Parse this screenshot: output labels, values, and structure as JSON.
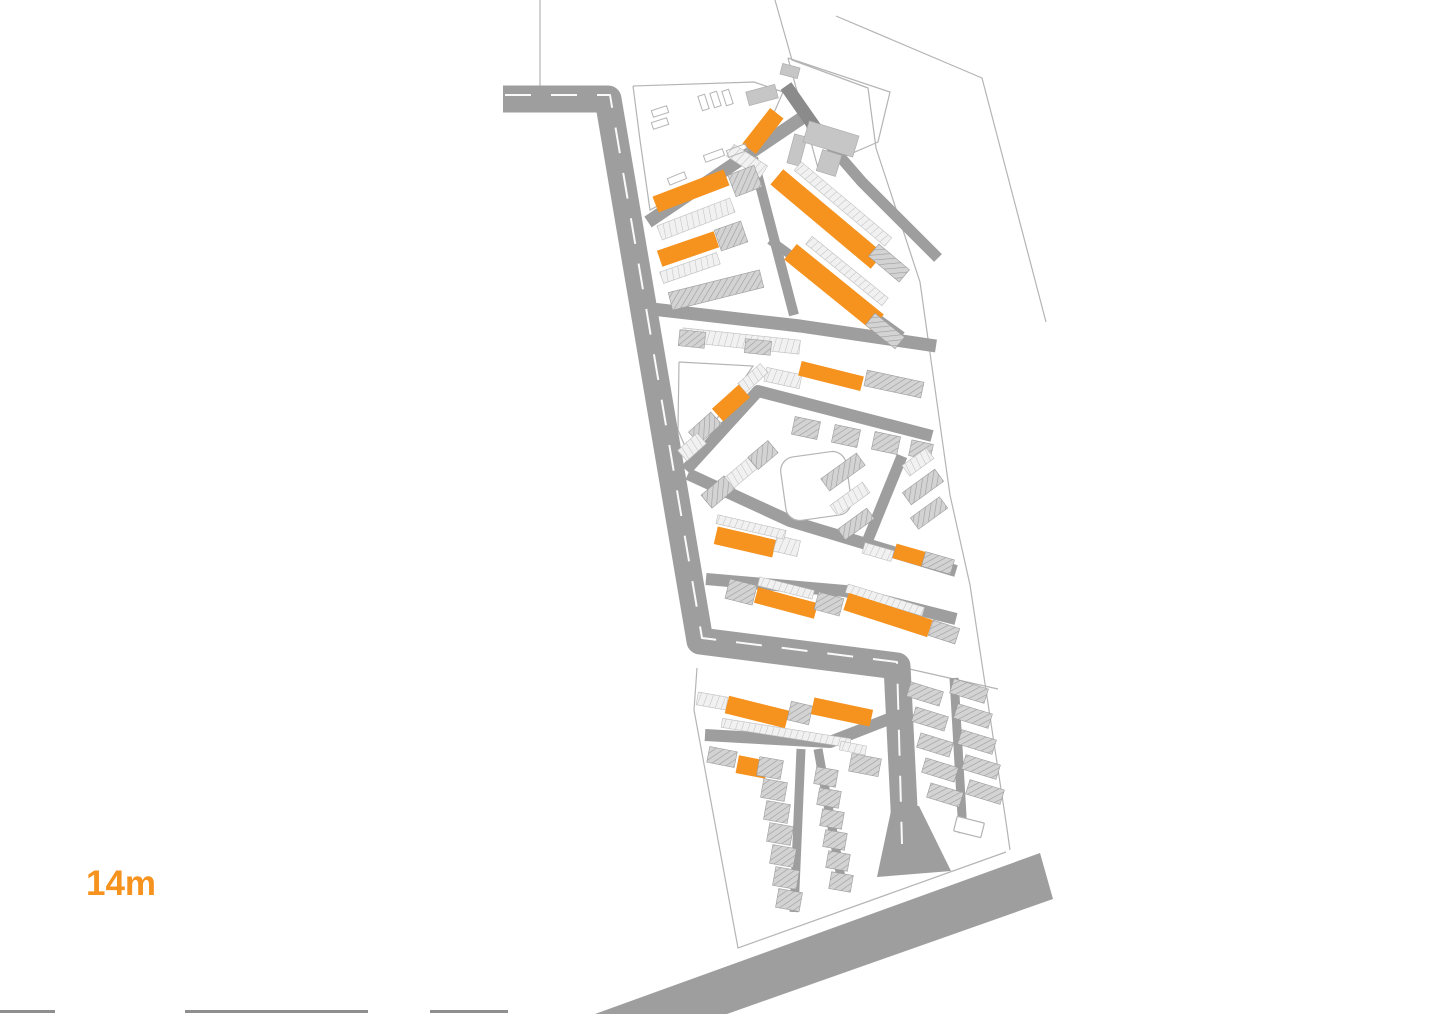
{
  "page": {
    "title": "site-plan",
    "label": {
      "text": "14m",
      "color": "#F6921E"
    }
  },
  "palette": {
    "background": "#ffffff",
    "orange": "#F6921E",
    "road": "#9E9E9E",
    "road_dark": "#8B8B8B",
    "centerline": "#FFFFFF",
    "hatch_fill": "#D3D3D3",
    "hatch_line": "#9C9C9C",
    "strip_fill": "#F1F1F1",
    "strip_line": "#BFBFBF",
    "solid_gray": "#C6C6C6",
    "outline": "#B4B4B4",
    "edge_mark": "#8F8F8F"
  },
  "legend": {
    "O": "highlighted-orange-building",
    "H": "hatched-gray-building",
    "S": "terraced-housing-strip",
    "G": "solid-gray-building"
  },
  "map": {
    "viewbox": [
      0,
      0,
      1436,
      1014
    ],
    "roads": [
      {
        "pts": [
          [
            503,
            99
          ],
          [
            608,
            99
          ],
          [
            700,
            641
          ],
          [
            897,
            666
          ],
          [
            906,
            848
          ]
        ],
        "w": 27,
        "dark": false
      },
      {
        "pts": [
          [
            648,
            222
          ],
          [
            802,
            118
          ]
        ],
        "w": 13,
        "dark": false
      },
      {
        "pts": [
          [
            786,
            86
          ],
          [
            816,
            129
          ]
        ],
        "w": 13,
        "dark": true
      },
      {
        "pts": [
          [
            816,
            129
          ],
          [
            862,
            182
          ],
          [
            938,
            258
          ]
        ],
        "w": 11,
        "dark": false
      },
      {
        "pts": [
          [
            770,
            240
          ],
          [
            902,
            336
          ]
        ],
        "w": 9,
        "dark": false
      },
      {
        "pts": [
          [
            753,
            158
          ],
          [
            789,
            296
          ],
          [
            794,
            315
          ]
        ],
        "w": 10,
        "dark": false
      },
      {
        "pts": [
          [
            652,
            309
          ],
          [
            800,
            326
          ],
          [
            936,
            346
          ]
        ],
        "w": 13,
        "dark": false
      },
      {
        "pts": [
          [
            686,
            470
          ],
          [
            758,
            391
          ],
          [
            932,
            436
          ]
        ],
        "w": 12,
        "dark": false
      },
      {
        "pts": [
          [
            688,
            474
          ],
          [
            790,
            521
          ],
          [
            956,
            571
          ]
        ],
        "w": 12,
        "dark": false
      },
      {
        "pts": [
          [
            902,
            456
          ],
          [
            867,
            542
          ]
        ],
        "w": 11,
        "dark": false
      },
      {
        "pts": [
          [
            706,
            579
          ],
          [
            845,
            591
          ],
          [
            956,
            619
          ]
        ],
        "w": 12,
        "dark": false
      },
      {
        "pts": [
          [
            705,
            735
          ],
          [
            830,
            742
          ],
          [
            889,
            719
          ]
        ],
        "w": 12,
        "dark": false
      },
      {
        "pts": [
          [
            801,
            749
          ],
          [
            794,
            912
          ]
        ],
        "w": 9,
        "dark": false
      },
      {
        "pts": [
          [
            818,
            749
          ],
          [
            843,
            889
          ]
        ],
        "w": 9,
        "dark": false
      },
      {
        "pts": [
          [
            954,
            678
          ],
          [
            963,
            833
          ]
        ],
        "w": 9,
        "dark": false
      }
    ],
    "road_polygons": [
      {
        "pts": [
          [
            595,
            1014
          ],
          [
            1040,
            853
          ],
          [
            1053,
            899
          ],
          [
            727,
            1014
          ]
        ]
      },
      {
        "pts": [
          [
            892,
            806
          ],
          [
            919,
            806
          ],
          [
            951,
            871
          ],
          [
            877,
            877
          ]
        ]
      }
    ],
    "centerlines": [
      {
        "pts": [
          [
            505,
            95
          ],
          [
            610,
            95
          ],
          [
            702,
            638
          ],
          [
            897,
            662
          ],
          [
            902,
            844
          ]
        ],
        "dash": "26 20",
        "w": 2
      }
    ],
    "outlines": [
      {
        "pts": [
          [
            775,
            0
          ],
          [
            792,
            60
          ],
          [
            868,
            88
          ],
          [
            876,
            148
          ],
          [
            920,
            282
          ],
          [
            950,
            495
          ],
          [
            970,
            585
          ],
          [
            1006,
            822
          ],
          [
            1010,
            850
          ]
        ]
      },
      {
        "pts": [
          [
            836,
            16
          ],
          [
            982,
            78
          ],
          [
            1046,
            322
          ]
        ]
      },
      {
        "pts": [
          [
            540,
            0
          ],
          [
            540,
            86
          ]
        ]
      },
      {
        "pts": [
          [
            697,
            668
          ],
          [
            694,
            710
          ],
          [
            738,
            948
          ],
          [
            1006,
            852
          ]
        ]
      },
      {
        "pts": [
          [
            633,
            86
          ],
          [
            754,
            82
          ],
          [
            783,
            92
          ],
          [
            757,
            152
          ],
          [
            650,
            210
          ],
          [
            640,
            140
          ],
          [
            633,
            86
          ]
        ]
      },
      {
        "pts": [
          [
            788,
            58
          ],
          [
            890,
            92
          ],
          [
            878,
            142
          ],
          [
            818,
            168
          ],
          [
            788,
            58
          ]
        ]
      },
      {
        "pts": [
          [
            679,
            362
          ],
          [
            753,
            366
          ],
          [
            690,
            458
          ],
          [
            678,
            430
          ],
          [
            679,
            362
          ]
        ]
      },
      {
        "pts": [
          [
            905,
            668
          ],
          [
            998,
            689
          ]
        ]
      }
    ],
    "buildings": [
      [
        "O",
        763,
        131,
        17,
        45,
        38
      ],
      [
        "G",
        762,
        95,
        30,
        14,
        -15
      ],
      [
        "G",
        790,
        71,
        18,
        11,
        15
      ],
      [
        "G",
        797,
        150,
        13,
        30,
        15
      ],
      [
        "G",
        831,
        139,
        52,
        22,
        17
      ],
      [
        "G",
        829,
        163,
        20,
        22,
        17
      ],
      [
        "S",
        747,
        161,
        40,
        14,
        33
      ],
      [
        "S",
        696,
        219,
        78,
        15,
        -21
      ],
      [
        "O",
        691,
        191,
        76,
        17,
        -21
      ],
      [
        "H",
        745,
        181,
        28,
        23,
        -21
      ],
      [
        "O",
        688,
        249,
        60,
        17,
        -19
      ],
      [
        "S",
        690,
        268,
        60,
        12,
        -19
      ],
      [
        "H",
        731,
        236,
        28,
        22,
        -19
      ],
      [
        "H",
        716,
        290,
        94,
        18,
        -14
      ],
      [
        "S",
        843,
        204,
        118,
        11,
        40
      ],
      [
        "O",
        827,
        219,
        131,
        20,
        40
      ],
      [
        "H",
        889,
        263,
        40,
        16,
        40
      ],
      [
        "S",
        847,
        271,
        98,
        10,
        39
      ],
      [
        "O",
        834,
        287,
        112,
        20,
        39
      ],
      [
        "H",
        885,
        331,
        38,
        15,
        39
      ],
      [
        "S",
        741,
        341,
        118,
        14,
        6
      ],
      [
        "H",
        692,
        339,
        26,
        16,
        6
      ],
      [
        "H",
        758,
        347,
        26,
        14,
        6
      ],
      [
        "S",
        783,
        378,
        36,
        14,
        12
      ],
      [
        "O",
        831,
        376,
        64,
        15,
        14
      ],
      [
        "H",
        894,
        384,
        58,
        16,
        12
      ],
      [
        "H",
        806,
        428,
        26,
        18,
        12
      ],
      [
        "H",
        846,
        436,
        26,
        18,
        12
      ],
      [
        "H",
        886,
        443,
        26,
        18,
        12
      ],
      [
        "H",
        921,
        450,
        22,
        16,
        12
      ],
      [
        "S",
        753,
        378,
        30,
        12,
        -42
      ],
      [
        "O",
        731,
        403,
        36,
        17,
        -42
      ],
      [
        "H",
        705,
        428,
        30,
        16,
        -42
      ],
      [
        "S",
        692,
        447,
        26,
        14,
        -42
      ],
      [
        "H",
        718,
        492,
        30,
        17,
        -40
      ],
      [
        "S",
        741,
        473,
        30,
        14,
        -40
      ],
      [
        "H",
        763,
        455,
        26,
        16,
        -40
      ],
      [
        "O",
        745,
        542,
        60,
        18,
        13
      ],
      [
        "S",
        787,
        546,
        24,
        16,
        13
      ],
      [
        "S",
        751,
        527,
        70,
        9,
        13
      ],
      [
        "H",
        843,
        472,
        44,
        15,
        -36
      ],
      [
        "S",
        850,
        499,
        40,
        13,
        -36
      ],
      [
        "H",
        856,
        524,
        36,
        13,
        -36
      ],
      [
        "S",
        918,
        462,
        30,
        13,
        -36
      ],
      [
        "H",
        923,
        487,
        40,
        15,
        -36
      ],
      [
        "H",
        929,
        513,
        36,
        14,
        -36
      ],
      [
        "S",
        878,
        552,
        30,
        11,
        16
      ],
      [
        "O",
        909,
        555,
        30,
        15,
        16
      ],
      [
        "H",
        938,
        563,
        30,
        15,
        16
      ],
      [
        "H",
        741,
        592,
        28,
        20,
        14
      ],
      [
        "S",
        786,
        588,
        56,
        9,
        14
      ],
      [
        "O",
        786,
        603,
        62,
        16,
        15
      ],
      [
        "H",
        829,
        604,
        26,
        18,
        15
      ],
      [
        "S",
        885,
        600,
        80,
        9,
        17
      ],
      [
        "O",
        888,
        615,
        88,
        18,
        18
      ],
      [
        "H",
        944,
        632,
        28,
        16,
        18
      ],
      [
        "S",
        712,
        701,
        30,
        13,
        10
      ],
      [
        "O",
        757,
        712,
        62,
        18,
        14
      ],
      [
        "H",
        800,
        713,
        22,
        19,
        13
      ],
      [
        "O",
        842,
        712,
        60,
        17,
        12
      ],
      [
        "S",
        786,
        733,
        130,
        9,
        9
      ],
      [
        "H",
        722,
        757,
        28,
        16,
        11
      ],
      [
        "O",
        752,
        767,
        30,
        18,
        11
      ],
      [
        "H",
        865,
        765,
        30,
        18,
        11
      ],
      [
        "S",
        853,
        748,
        26,
        9,
        11
      ],
      [
        "H",
        770,
        768,
        24,
        19,
        10
      ],
      [
        "H",
        774,
        790,
        24,
        19,
        10
      ],
      [
        "H",
        777,
        812,
        24,
        19,
        10
      ],
      [
        "H",
        780,
        834,
        24,
        19,
        10
      ],
      [
        "H",
        783,
        856,
        24,
        19,
        10
      ],
      [
        "H",
        786,
        878,
        24,
        19,
        10
      ],
      [
        "H",
        789,
        900,
        24,
        19,
        10
      ],
      [
        "H",
        826,
        777,
        22,
        17,
        10
      ],
      [
        "H",
        829,
        798,
        22,
        17,
        10
      ],
      [
        "H",
        832,
        819,
        22,
        17,
        10
      ],
      [
        "H",
        835,
        840,
        22,
        17,
        10
      ],
      [
        "H",
        838,
        861,
        22,
        17,
        10
      ],
      [
        "H",
        841,
        882,
        22,
        17,
        10
      ],
      [
        "H",
        925,
        694,
        34,
        15,
        17
      ],
      [
        "H",
        930,
        719,
        34,
        15,
        17
      ],
      [
        "H",
        935,
        745,
        34,
        15,
        17
      ],
      [
        "H",
        940,
        770,
        34,
        15,
        17
      ],
      [
        "H",
        945,
        795,
        34,
        15,
        17
      ],
      [
        "H",
        969,
        691,
        36,
        15,
        17
      ],
      [
        "H",
        973,
        716,
        36,
        15,
        17
      ],
      [
        "H",
        977,
        742,
        36,
        15,
        17
      ],
      [
        "H",
        981,
        767,
        36,
        15,
        17
      ],
      [
        "H",
        985,
        792,
        36,
        15,
        17
      ]
    ],
    "open_rects": [
      {
        "cx": 816,
        "cy": 486,
        "w": 66,
        "h": 64,
        "rot": -8,
        "rx": 14
      },
      {
        "cx": 969,
        "cy": 827,
        "w": 28,
        "h": 15,
        "rot": 14,
        "rx": 1
      }
    ],
    "teeth": [
      [
        652,
        108,
        16,
        7,
        -18
      ],
      [
        652,
        120,
        16,
        7,
        -18
      ],
      [
        700,
        95,
        7,
        15,
        -18
      ],
      [
        712,
        92,
        7,
        15,
        -18
      ],
      [
        724,
        90,
        7,
        15,
        -18
      ],
      [
        704,
        152,
        20,
        7,
        -20
      ],
      [
        727,
        147,
        20,
        7,
        -20
      ],
      [
        668,
        175,
        18,
        7,
        -22
      ]
    ],
    "edge_marks": {
      "y": 1010,
      "h": 3,
      "segments": [
        [
          0,
          55
        ],
        [
          185,
          368
        ],
        [
          430,
          508
        ]
      ]
    }
  }
}
